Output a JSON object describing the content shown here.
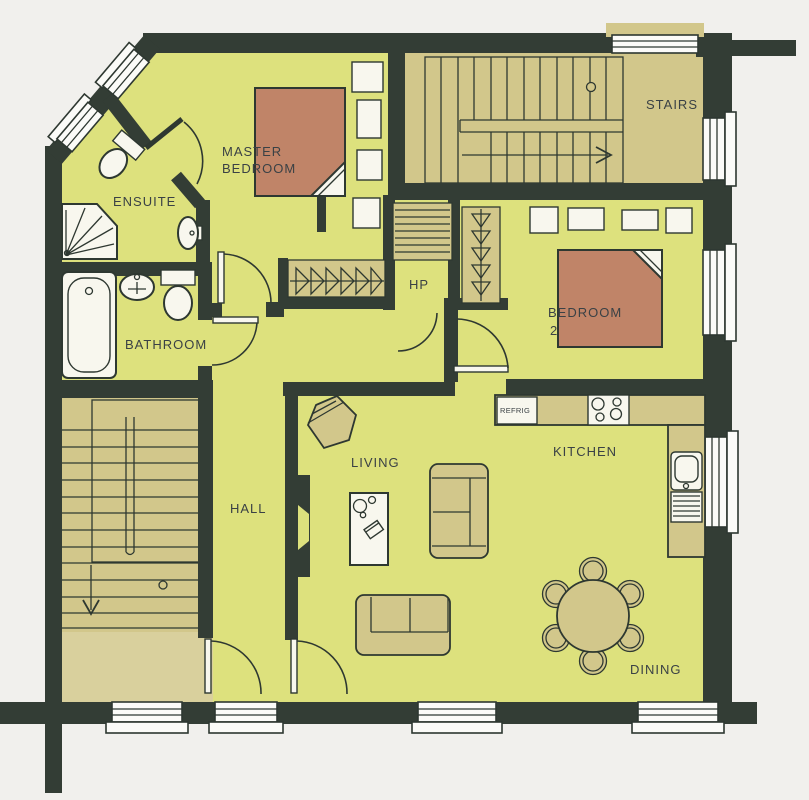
{
  "document": {
    "type": "apartment-floor-plan"
  },
  "colors": {
    "background": "#f1f0ed",
    "wall": "#333d35",
    "floor": "#dde17d",
    "stairs_and_closets": "#d2c78b",
    "lobby": "#d9d09d",
    "bed": "#c08468",
    "fixture_white": "#f8f7ee",
    "outline": "#2e3831",
    "label_text": "#3a4145"
  },
  "rooms": {
    "ensuite": {
      "label": "ENSUITE"
    },
    "master_bedroom": {
      "label": [
        "MASTER",
        "BEDROOM"
      ]
    },
    "stairs": {
      "label": "STAIRS"
    },
    "hot_press": {
      "label": "HP"
    },
    "bedroom_2": {
      "label": [
        "BEDROOM",
        "2"
      ]
    },
    "bathroom": {
      "label": "BATHROOM"
    },
    "hall": {
      "label": "HALL"
    },
    "living": {
      "label": "LIVING"
    },
    "kitchen": {
      "label": "KITCHEN"
    },
    "dining": {
      "label": "DINING"
    }
  },
  "appliances": {
    "refrigerator": {
      "label": "REFRIG"
    }
  }
}
